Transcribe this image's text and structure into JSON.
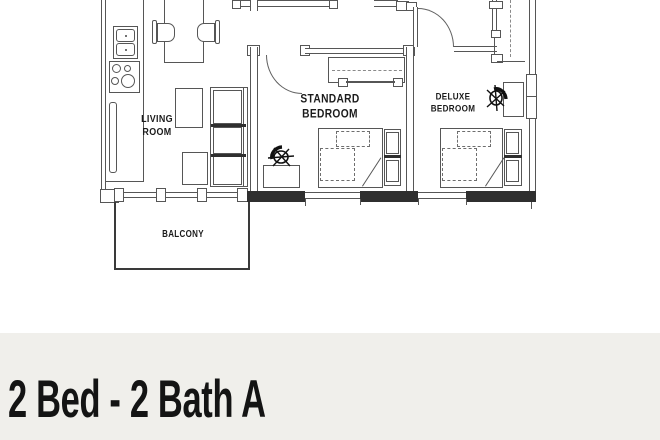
{
  "plan": {
    "labels": {
      "living_room": "LIVING\nROOM",
      "standard_bedroom": "STANDARD\nBEDROOM",
      "deluxe_bedroom": "DELUXE\nBEDROOM",
      "balcony": "BALCONY"
    },
    "icons": {
      "desk_chair": "desk-chair-top-view"
    },
    "colors": {
      "line": "#565656",
      "wall_dark": "#2f2f2f",
      "label_text": "#1b1b1b"
    }
  },
  "footer": {
    "title": "2 Bed - 2 Bath A",
    "background": "#f0efeb",
    "text_color": "#141414"
  }
}
